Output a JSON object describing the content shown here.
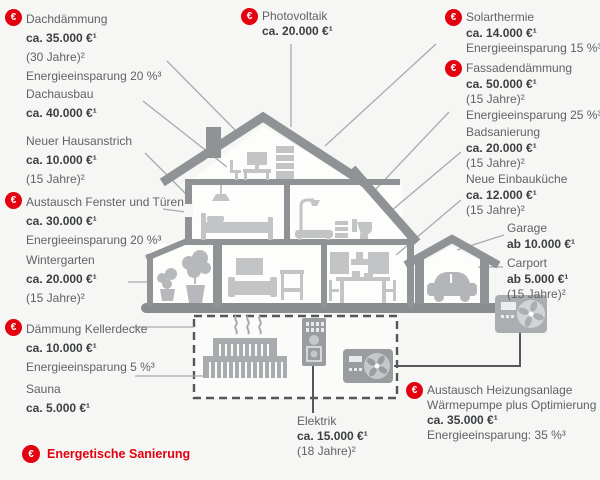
{
  "title": "Energetische Sanierung – Kosten von Modernisierungsmaßnahmen am Haus",
  "colors": {
    "background": "#f6f6f4",
    "brand_red": "#e3000f",
    "house_gray": "#909396",
    "furniture_gray": "#c2c4c6",
    "text_dark": "#3b3f43",
    "text_gray": "#5f6367"
  },
  "icons": {
    "energy_glyph": "€"
  },
  "legend": {
    "label": "Energetische Sanierung"
  },
  "labels": {
    "dachdaemmung": {
      "eco": true,
      "name": "Dachdämmung",
      "price": "ca. 35.000 €¹",
      "duration": "(30 Jahre)²",
      "savings": "Energieeinsparung 20 %³"
    },
    "dachausbau": {
      "eco": false,
      "name": "Dachausbau",
      "price": "ca. 40.000 €¹"
    },
    "hausanstrich": {
      "eco": false,
      "name": "Neuer Hausanstrich",
      "price": "ca. 10.000 €¹",
      "duration": "(15 Jahre)²"
    },
    "fenster": {
      "eco": true,
      "name": "Austausch Fenster und Türen",
      "price": "ca. 30.000 €¹",
      "savings": "Energieeinsparung 20 %³"
    },
    "wintergarten": {
      "eco": false,
      "name": "Wintergarten",
      "price": "ca. 20.000 €¹",
      "duration": "(15 Jahre)²"
    },
    "kellerdecke": {
      "eco": true,
      "name": "Dämmung Kellerdecke",
      "price": "ca. 10.000 €¹",
      "savings": "Energieeinsparung 5 %³"
    },
    "sauna": {
      "eco": false,
      "name": "Sauna",
      "price": "ca. 5.000 €¹"
    },
    "photovoltaik": {
      "eco": true,
      "name": "Photovoltaik",
      "price": "ca. 20.000 €¹"
    },
    "solarthermie": {
      "eco": true,
      "name": "Solarthermie",
      "price": "ca. 14.000 €¹",
      "savings": "Energieeinsparung 15 %³"
    },
    "fassade": {
      "eco": true,
      "name": "Fassadendämmung",
      "price": "ca. 50.000 €¹",
      "duration": "(15 Jahre)²",
      "savings": "Energieeinsparung 25 %³"
    },
    "badsanierung": {
      "eco": false,
      "name": "Badsanierung",
      "price": "ca. 20.000 €¹",
      "duration": "(15 Jahre)²"
    },
    "einbaukueche": {
      "eco": false,
      "name": "Neue Einbauküche",
      "price": "ca. 12.000 €¹",
      "duration": "(15 Jahre)²"
    },
    "garage": {
      "eco": false,
      "name": "Garage",
      "price": "ab 10.000 €¹"
    },
    "carport": {
      "eco": false,
      "name": "Carport",
      "price": "ab 5.000 €¹",
      "duration": "(15 Jahre)²"
    },
    "heizung": {
      "eco": true,
      "name": "Austausch Heizungsanlage",
      "name2": "Wärmepumpe plus Optimierung",
      "price": "ca. 35.000 €¹",
      "savings": "Energieeinsparung: 35 %³"
    },
    "elektrik": {
      "eco": false,
      "name": "Elektrik",
      "price": "ca. 15.000 €¹",
      "duration": "(18 Jahre)²"
    }
  }
}
